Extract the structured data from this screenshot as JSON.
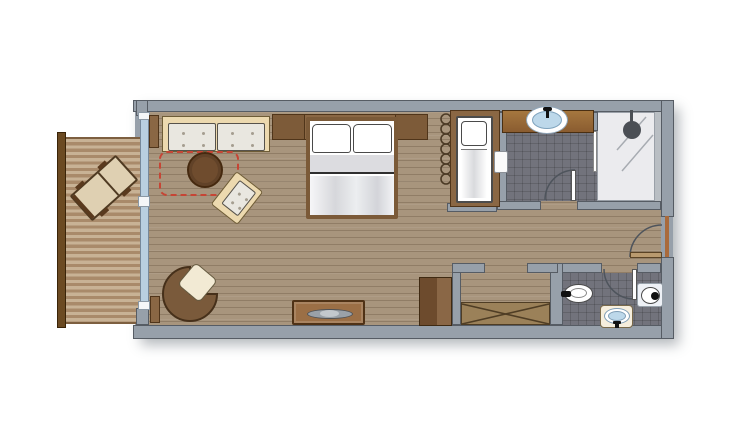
{
  "meta": {
    "description": "Top-down hotel room floor plan with balcony, living-bedroom, bathroom, shower, entry hall, WC and closet",
    "canvas_width": 754,
    "canvas_height": 435
  },
  "colors": {
    "wall": "#97a0aa",
    "wall_line": "#565c64",
    "floor": "#a8957d",
    "tile": "#72737c",
    "shower_floor": "#ebebee",
    "deck_light": "#c8b295",
    "deck_dark": "#a98a6a",
    "railing": "#6b4a22",
    "glass": "#b9cfe0",
    "wood": "#8a6744",
    "wood_dark": "#50351a",
    "cream": "#ecd9af",
    "cushion": "#e9e7e0",
    "rug_red": "#c64535",
    "table_brown": "#6f4c2e",
    "chair_brown": "#7a5a3b",
    "seat_cream": "#f2ead4",
    "sheet_gray": "#dcdce0",
    "sink_blue": "#bdd8ea",
    "fixture_line": "#4a4a4a",
    "arc_line": "#4e545c",
    "console": "#9b6f46",
    "cabinet_dark": "#6d4b2d",
    "cabinet_light": "#8a6746",
    "rack": "#9b8159",
    "head_gray": "#4b4f55",
    "leaf_tan": "#b99a6f",
    "threshold": "#a96a3c",
    "basin_cream": "#f6eedd",
    "pedestal": "#eef1f6"
  },
  "plan": {
    "rooms": [
      {
        "name": "balcony"
      },
      {
        "name": "living-bedroom"
      },
      {
        "name": "bathroom"
      },
      {
        "name": "shower"
      },
      {
        "name": "entry-hall"
      },
      {
        "name": "wc"
      },
      {
        "name": "closet-niche"
      }
    ],
    "furniture": [
      {
        "name": "sun-lounger",
        "room": "balcony"
      },
      {
        "name": "sofa",
        "room": "living-bedroom"
      },
      {
        "name": "rug-outline-dashed",
        "room": "living-bedroom"
      },
      {
        "name": "round-coffee-table",
        "room": "living-bedroom"
      },
      {
        "name": "armchair",
        "room": "living-bedroom"
      },
      {
        "name": "desk-chair",
        "room": "living-bedroom"
      },
      {
        "name": "tv-console",
        "room": "living-bedroom"
      },
      {
        "name": "double-bed",
        "room": "living-bedroom"
      },
      {
        "name": "headboard-with-nightstands",
        "room": "living-bedroom"
      },
      {
        "name": "radiator-coil",
        "room": "living-bedroom"
      },
      {
        "name": "crib-single-bed",
        "room": "living-bedroom"
      },
      {
        "name": "minibar-cabinet",
        "room": "living-bedroom"
      },
      {
        "name": "luggage-rack-x",
        "room": "closet-niche"
      }
    ],
    "fixtures": [
      {
        "name": "vanity-counter-sink",
        "room": "bathroom"
      },
      {
        "name": "shower-head",
        "room": "shower"
      },
      {
        "name": "toilet",
        "room": "wc"
      },
      {
        "name": "toilet-2",
        "room": "wc"
      },
      {
        "name": "washbasin",
        "room": "wc"
      }
    ],
    "doors": [
      {
        "name": "entry-door",
        "wall": "right"
      },
      {
        "name": "bathroom-door",
        "wall": "bathroom-south"
      },
      {
        "name": "wc-door",
        "wall": "wc-north"
      },
      {
        "name": "sliding-pocket-panel",
        "wall": "bathroom-west"
      },
      {
        "name": "balcony-glass-wall",
        "wall": "left"
      }
    ]
  }
}
